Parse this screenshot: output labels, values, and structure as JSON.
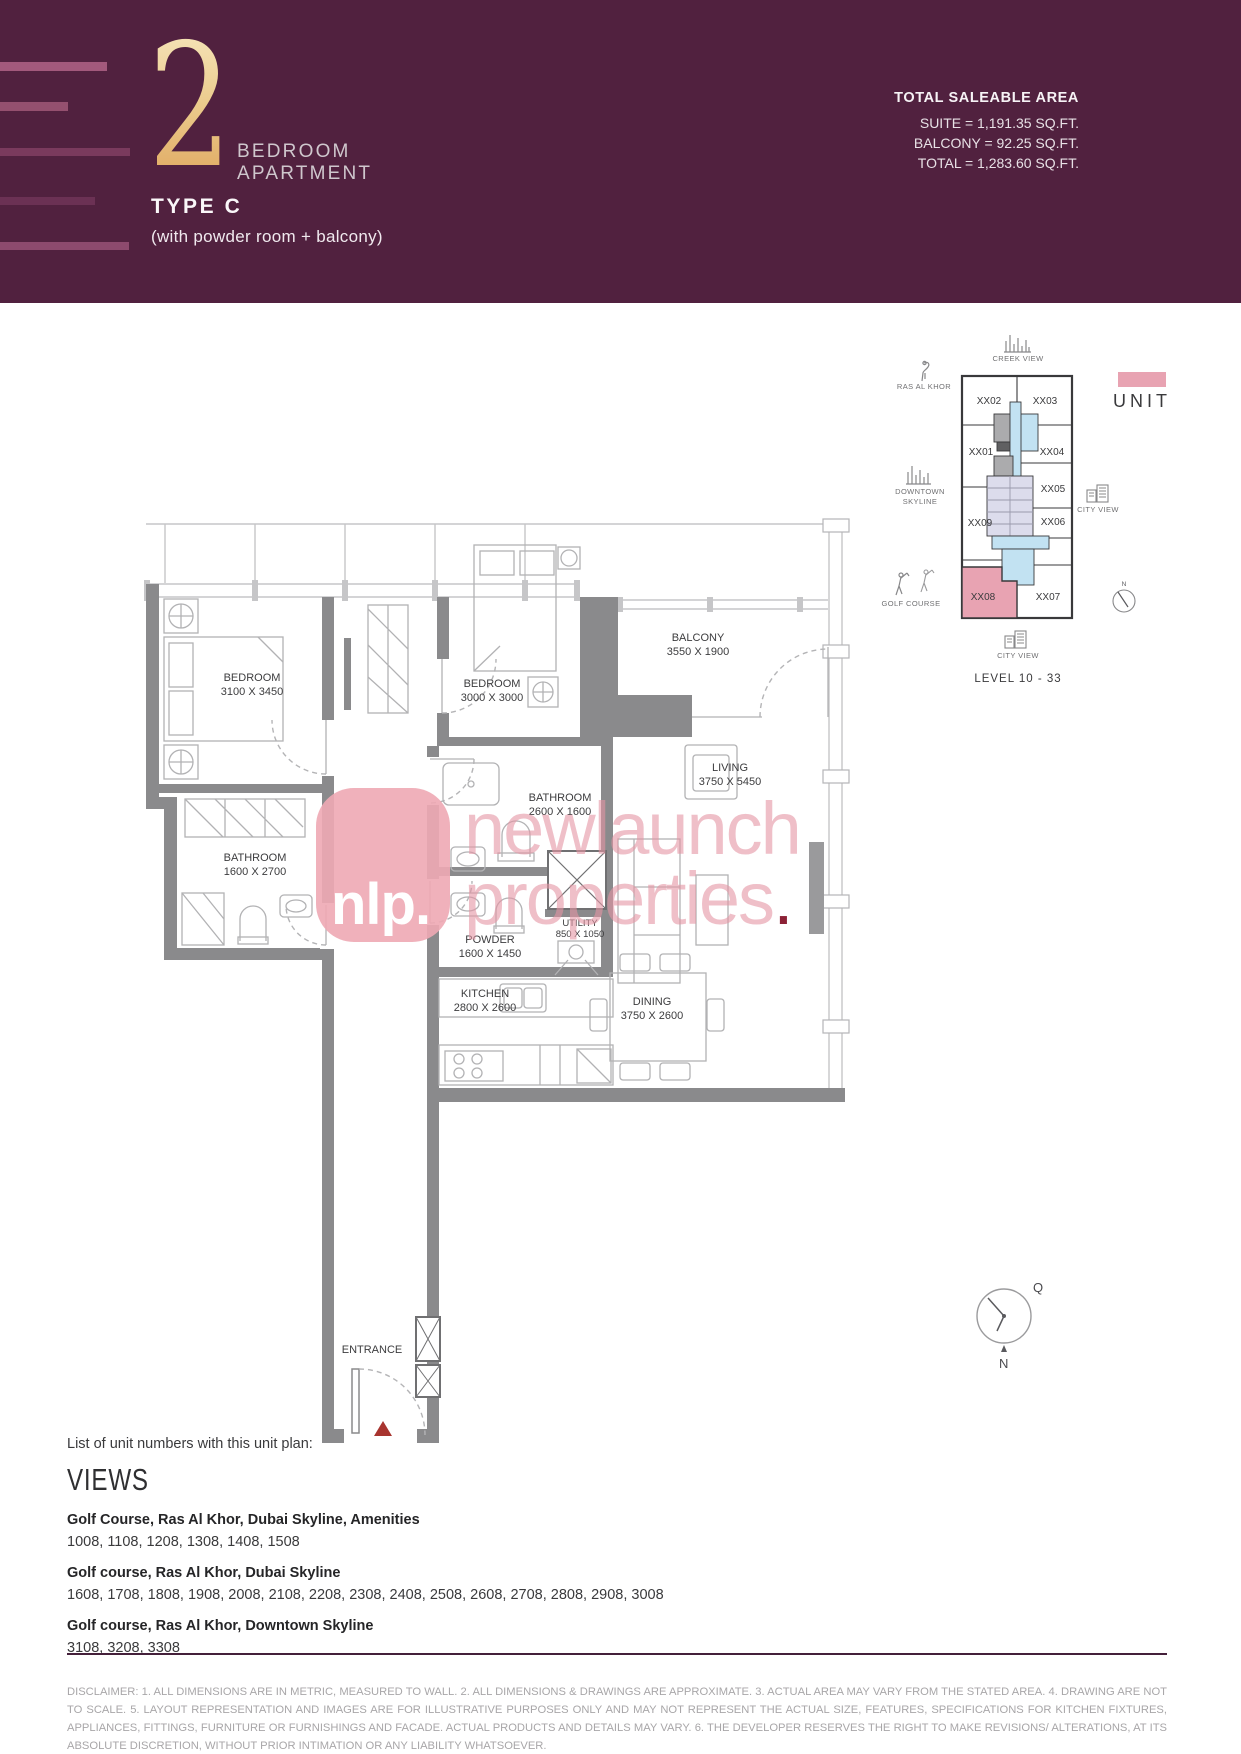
{
  "header": {
    "number": "2",
    "title_line1": "BEDROOM",
    "title_line2": "APARTMENT",
    "type": "TYPE C",
    "subtitle": "(with powder room + balcony)",
    "area_heading": "TOTAL SALEABLE AREA",
    "area_suite": "SUITE = 1,191.35 SQ.FT.",
    "area_balcony": "BALCONY = 92.25 SQ.FT.",
    "area_total": "TOTAL = 1,283.60 SQ.FT.",
    "colors": {
      "band": "#51213f",
      "gold": "#e3ab62"
    }
  },
  "locator": {
    "creek_view": "CREEK VIEW",
    "ras_al_khor": "RAS AL KHOR",
    "downtown_line1": "DOWNTOWN",
    "downtown_line2": "SKYLINE",
    "city_view_right": "CITY VIEW",
    "golf_course": "GOLF COURSE",
    "city_view_bottom": "CITY VIEW",
    "level": "LEVEL 10 - 33",
    "legend_unit": "UNIT",
    "compass_n": "N",
    "units": [
      "XX01",
      "XX02",
      "XX03",
      "XX04",
      "XX05",
      "XX06",
      "XX07",
      "XX08",
      "XX09"
    ],
    "highlighted_unit": "XX08",
    "highlight_color": "#e8a3b2"
  },
  "floorplan": {
    "bedroom1_name": "BEDROOM",
    "bedroom1_dims": "3100 X 3450",
    "bedroom2_name": "BEDROOM",
    "bedroom2_dims": "3000 X 3000",
    "balcony_name": "BALCONY",
    "balcony_dims": "3550 X 1900",
    "bathroom1_name": "BATHROOM",
    "bathroom1_dims": "2600 X 1600",
    "bathroom2_name": "BATHROOM",
    "bathroom2_dims": "1600 X 2700",
    "living_name": "LIVING",
    "living_dims": "3750 X 5450",
    "powder_name": "POWDER",
    "powder_dims": "1600 X 1450",
    "utility_name": "UTILITY",
    "utility_dims": "850 X 1050",
    "kitchen_name": "KITCHEN",
    "kitchen_dims": "2800 X 2600",
    "dining_name": "DINING",
    "dining_dims": "3750 X 2600",
    "entrance": "ENTRANCE"
  },
  "watermark": {
    "logo": "nlp.",
    "line1": "newlaunch",
    "line2": "properties",
    "dot": "."
  },
  "footer": {
    "list_label": "List of unit numbers with this unit plan:",
    "views_heading": "VIEWS",
    "groups": [
      {
        "title": "Golf Course, Ras Al Khor, Dubai Skyline, Amenities",
        "units": "1008, 1108, 1208, 1308, 1408, 1508"
      },
      {
        "title": "Golf course, Ras Al Khor, Dubai Skyline",
        "units": "1608, 1708, 1808, 1908, 2008, 2108, 2208, 2308, 2408, 2508, 2608, 2708, 2808, 2908, 3008"
      },
      {
        "title": "Golf course, Ras Al Khor, Downtown Skyline",
        "units": "3108, 3208, 3308"
      }
    ],
    "compass_q": "Q",
    "compass_n": "N",
    "disclaimer": "DISCLAIMER: 1. ALL DIMENSIONS ARE IN METRIC, MEASURED TO WALL. 2. ALL DIMENSIONS & DRAWINGS ARE APPROXIMATE. 3. ACTUAL AREA MAY VARY FROM THE STATED AREA. 4. DRAWING ARE NOT TO SCALE. 5. LAYOUT REPRESENTATION AND IMAGES ARE FOR ILLUSTRATIVE PURPOSES ONLY AND MAY NOT REPRESENT THE ACTUAL SIZE, FEATURES, SPECIFICATIONS FOR KITCHEN FIXTURES, APPLIANCES, FITTINGS, FURNITURE OR FURNISHINGS AND FACADE. ACTUAL PRODUCTS AND DETAILS MAY VARY. 6. THE DEVELOPER RESERVES THE RIGHT TO MAKE REVISIONS/ ALTERATIONS, AT ITS ABSOLUTE DISCRETION, WITHOUT PRIOR INTIMATION OR ANY LIABILITY WHATSOEVER."
  }
}
